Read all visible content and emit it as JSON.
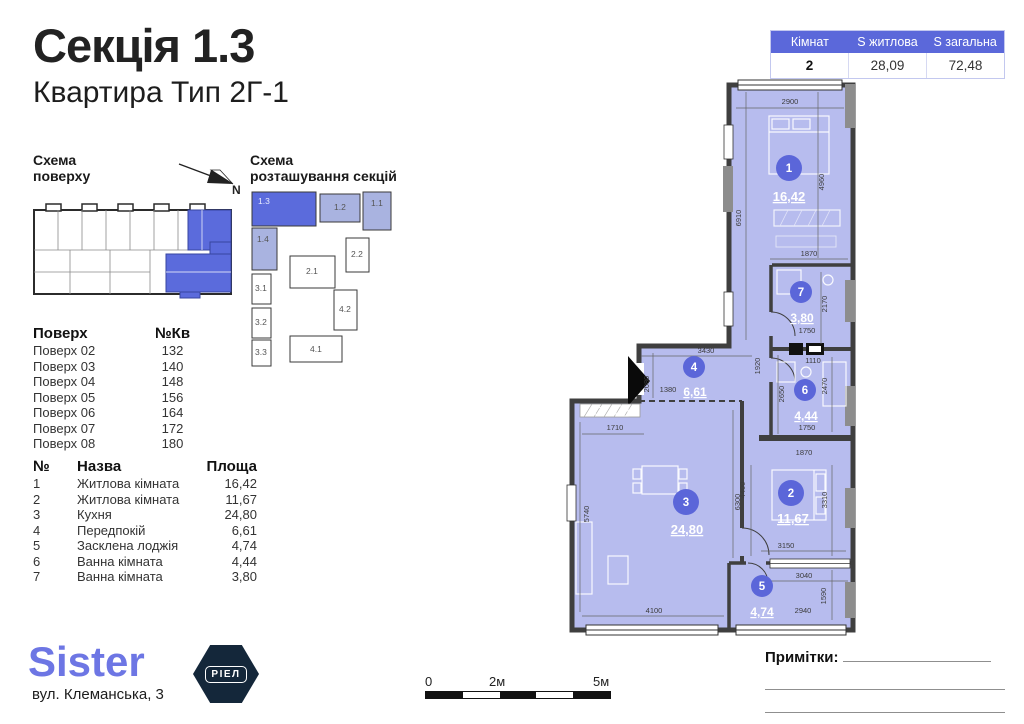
{
  "title": "Секція 1.3",
  "subtitle": "Квартира Тип 2Г-1",
  "summary_table": {
    "col1": "Кімнат",
    "col2": "S житлова",
    "col3": "S загальна",
    "val1": "2",
    "val2": "28,09",
    "val3": "72,48"
  },
  "floor_scheme": {
    "title_l1": "Схема",
    "title_l2": "поверху",
    "north": "N"
  },
  "section_scheme": {
    "title_l1": "Схема",
    "title_l2": "розташування секцій",
    "s13": "1.3",
    "s12": "1.2",
    "s11": "1.1",
    "s14": "1.4",
    "s22": "2.2",
    "s31": "3.1",
    "s21": "2.1",
    "s32": "3.2",
    "s42": "4.2",
    "s33": "3.3",
    "s41": "4.1"
  },
  "floors_table": {
    "h1": "Поверх",
    "h2": "№Кв",
    "rows": [
      [
        "Поверх 02",
        "132"
      ],
      [
        "Поверх 03",
        "140"
      ],
      [
        "Поверх 04",
        "148"
      ],
      [
        "Поверх 05",
        "156"
      ],
      [
        "Поверх 06",
        "164"
      ],
      [
        "Поверх 07",
        "172"
      ],
      [
        "Поверх 08",
        "180"
      ]
    ]
  },
  "rooms_table": {
    "h1": "№",
    "h2": "Назва",
    "h3": "Площа",
    "rows": [
      [
        "1",
        "Житлова кімната",
        "16,42"
      ],
      [
        "2",
        "Житлова кімната",
        "11,67"
      ],
      [
        "3",
        "Кухня",
        "24,80"
      ],
      [
        "4",
        "Передпокій",
        "6,61"
      ],
      [
        "5",
        "Засклена лоджія",
        "4,74"
      ],
      [
        "6",
        "Ванна кімната",
        "4,44"
      ],
      [
        "7",
        "Ванна кімната",
        "3,80"
      ]
    ]
  },
  "brand": {
    "name": "Sister",
    "badge": "РІЕЛ",
    "address": "вул. Клеманська, 3"
  },
  "plan": {
    "rooms": {
      "r1": {
        "num": "1",
        "area": "16,42"
      },
      "r2": {
        "num": "2",
        "area": "11,67"
      },
      "r3": {
        "num": "3",
        "area": "24,80"
      },
      "r4": {
        "num": "4",
        "area": "6,61"
      },
      "r5": {
        "num": "5",
        "area": "4,74"
      },
      "r6": {
        "num": "6",
        "area": "4,44"
      },
      "r7": {
        "num": "7",
        "area": "3,80"
      }
    },
    "dims": {
      "d2900": "2900",
      "d6910": "6910",
      "d4960": "4960",
      "d1870": "1870",
      "d2170": "2170",
      "d1750": "1750",
      "d1110": "1110",
      "d2470": "2470",
      "d2650": "2650",
      "d1920": "1920",
      "d3430": "3430",
      "d2080": "2080",
      "d1380": "1380",
      "d4400": "4400",
      "d3310": "3310",
      "d3150": "3150",
      "d1710": "1710",
      "d5740": "5740",
      "d6300": "6300",
      "d4100": "4100",
      "d3040": "3040",
      "d2940": "2940",
      "d1590": "1590"
    }
  },
  "scale_bar": {
    "l0": "0",
    "l2": "2м",
    "l5": "5м"
  },
  "notes_label": "Примітки:",
  "colors": {
    "accent": "#5b66d9",
    "room_fill": "#b7bcee",
    "wall": "#3f3f3f",
    "muted_section": "#a9b3e0",
    "badge_bg": "#14273a",
    "logo": "#6d76e4"
  }
}
